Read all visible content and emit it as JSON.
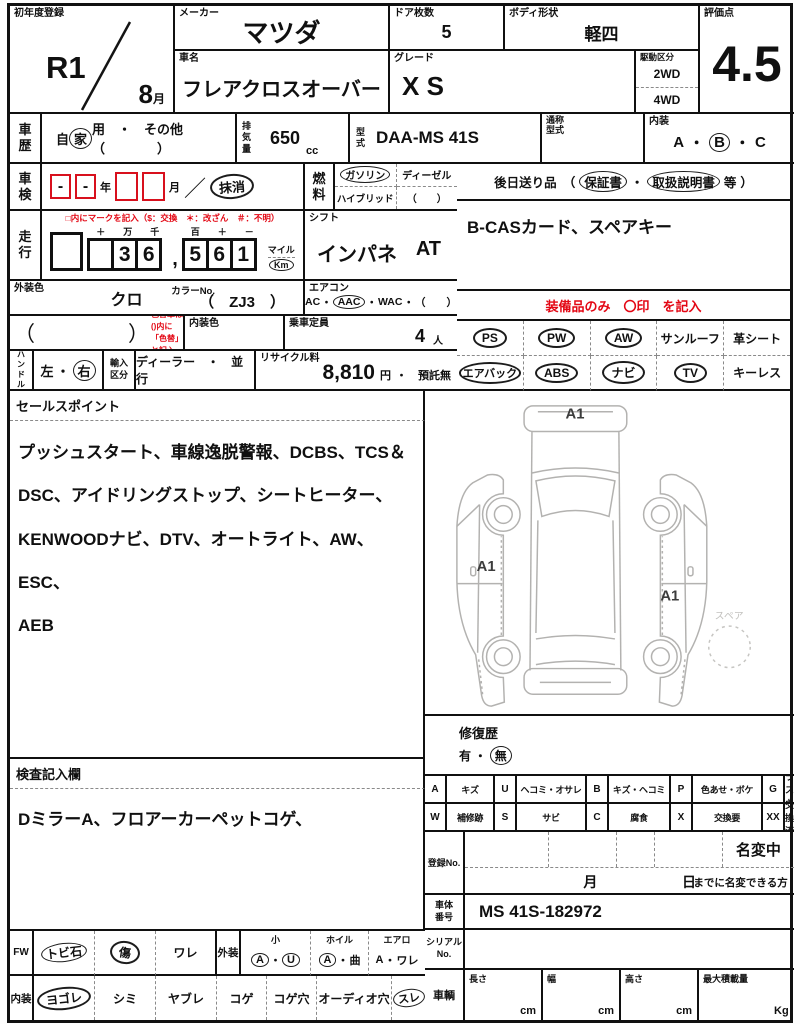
{
  "header": {
    "first_reg": {
      "label": "初年度登録",
      "year": "R1",
      "month": "8",
      "month_unit": "月"
    },
    "maker": {
      "label": "メーカー",
      "value": "マツダ"
    },
    "car_name": {
      "label": "車名",
      "value": "フレアクロスオーバー"
    },
    "doors": {
      "label": "ドア枚数",
      "value": "5"
    },
    "body_shape": {
      "label": "ボディ形状",
      "value": "軽四"
    },
    "grade": {
      "label": "グレード",
      "value": "X S"
    },
    "drive": {
      "label": "駆動区分",
      "opt1": "2WD",
      "opt2": "4WD"
    },
    "score": {
      "label": "評価点",
      "value": "4.5"
    }
  },
  "row2": {
    "history": {
      "label": "車歴",
      "pre": "自",
      "circled": "家",
      "post": "用　・　その他　（　　　　）"
    },
    "displacement": {
      "label": "排気量",
      "value": "650",
      "unit": "cc"
    },
    "model": {
      "label": "型式",
      "value": "DAA-MS 41S"
    },
    "alias": {
      "label": "通称\n型式",
      "value": ""
    },
    "interior_grade": {
      "label": "内装",
      "a": "A",
      "s1": "・",
      "b": "B",
      "s2": "・",
      "c": "C"
    }
  },
  "row3": {
    "shaken": {
      "label": "車検",
      "box1": "-",
      "box2": "-",
      "year": "年",
      "month": "月",
      "slash": "／",
      "stamp": "抹消"
    },
    "fuel": {
      "label": "燃料",
      "o1": "ガソリン",
      "o2": "ディーゼル",
      "o3": "ハイブリッド",
      "o4": "（　　）"
    },
    "send_later": {
      "pre": "後日送り品　（",
      "item1": "保証書",
      "sep": "・",
      "item2": "取扱説明書",
      "etc": "等",
      "post": "）"
    }
  },
  "row4": {
    "mileage": {
      "label": "走行",
      "note": "□内にマークを記入（$：交換　＊：改ざん　＃：不明）",
      "heads1": [
        "＋",
        "万",
        "千"
      ],
      "digits1": [
        "",
        "3",
        "6"
      ],
      "comma": ",",
      "heads2": [
        "百",
        "＋",
        "－"
      ],
      "digits2": [
        "5",
        "6",
        "1"
      ],
      "mile": "マイル",
      "km": "Km"
    },
    "shift": {
      "label": "シフト",
      "value": "インパネ",
      "trans": "AT"
    },
    "accessories": "B-CASカード、スペアキー"
  },
  "row5": {
    "ext_color": {
      "label": "外装色",
      "value": "クロ",
      "color_no_label": "カラーNo.",
      "color_no": "（　ZJ3　）"
    },
    "aircon": {
      "label": "エアコン",
      "o1": "AC",
      "s1": "・",
      "o2": "AAC",
      "s2": "・",
      "o3": "WAC",
      "s3": "・",
      "o4": "（　　）"
    },
    "equip_note": "装備品のみ　〇印　を記入"
  },
  "row6": {
    "color_change": {
      "paren": "（　　　　　）",
      "note": "色替車は()内に\n「色替」と記入"
    },
    "int_color": {
      "label": "内装色",
      "value": ""
    },
    "capacity": {
      "label": "乗車定員",
      "value": "4",
      "unit": "人"
    }
  },
  "row7": {
    "handle": {
      "label": "ハンドル",
      "left": "左",
      "sep": "・",
      "right": "右"
    },
    "import": {
      "label": "輸入\n区分",
      "value": "ディーラー　・　並行"
    },
    "recycle": {
      "label": "リサイクル料",
      "fee": "8,810",
      "yen": "円",
      "suffix": "・　預託無"
    }
  },
  "equipment": {
    "row1": [
      {
        "label": "PS",
        "circled": true
      },
      {
        "label": "PW",
        "circled": true
      },
      {
        "label": "AW",
        "circled": true
      },
      {
        "label": "サンルーフ",
        "circled": false
      },
      {
        "label": "革シート",
        "circled": false
      }
    ],
    "row2": [
      {
        "label": "エアバック",
        "circled": true
      },
      {
        "label": "ABS",
        "circled": true
      },
      {
        "label": "ナビ",
        "circled": true
      },
      {
        "label": "TV",
        "circled": true
      },
      {
        "label": "キーレス",
        "circled": false
      }
    ]
  },
  "sales_point": {
    "label": "セールスポイント",
    "text": "プッシュスタート、車線逸脱警報、DCBS、TCS＆\nDSC、アイドリングストップ、シートヒーター、\nKENWOODナビ、DTV、オートライト、AW、ESC、\nAEB"
  },
  "inspection": {
    "label": "検査記入欄",
    "text": "DミラーA、フロアーカーペットコゲ、"
  },
  "diagram": {
    "a1_top": "A1",
    "a1_left": "A1",
    "a1_right": "A1",
    "spare": "スペア"
  },
  "repair": {
    "label": "修復歴",
    "yes": "有",
    "sep": "・",
    "no": "無"
  },
  "legend": {
    "row1": [
      {
        "k": "A",
        "v": "キズ"
      },
      {
        "k": "U",
        "v": "ヘコミ・オサレ"
      },
      {
        "k": "B",
        "v": "キズ・ヘコミ"
      },
      {
        "k": "P",
        "v": "色あせ・ボケ"
      },
      {
        "k": "G",
        "v": "ガラスキズ"
      }
    ],
    "row2": [
      {
        "k": "W",
        "v": "補修跡"
      },
      {
        "k": "S",
        "v": "サビ"
      },
      {
        "k": "C",
        "v": "腐食"
      },
      {
        "k": "X",
        "v": "交換要"
      },
      {
        "k": "XX",
        "v": "交換済"
      }
    ]
  },
  "reg_no": {
    "label": "登録No.",
    "name_change": "名変中",
    "month": "月",
    "day": "日",
    "note": "までに名変できる方"
  },
  "chassis": {
    "label": "車体\n番号",
    "value": "MS 41S-182972"
  },
  "serial": {
    "label": "シリアル\nNo.",
    "value": ""
  },
  "vehicle": {
    "label": "車輌",
    "dims": [
      {
        "label": "長さ",
        "unit": "cm"
      },
      {
        "label": "幅",
        "unit": "cm"
      },
      {
        "label": "高さ",
        "unit": "cm"
      },
      {
        "label": "最大積載量",
        "unit": "Kg"
      }
    ]
  },
  "bottom_left": {
    "row1": {
      "label": "FW",
      "cells": [
        {
          "label": "トビ石",
          "circled": true
        },
        {
          "label": "傷",
          "circled": true
        },
        {
          "label": "ワレ",
          "circled": false
        }
      ],
      "ext_label": "外装",
      "sub": [
        {
          "head": "小",
          "p1": "A",
          "s": "・",
          "p2": "U"
        },
        {
          "head": "ホイル",
          "p1": "A",
          "s": "・",
          "p2": "曲"
        },
        {
          "head": "エアロ",
          "p1": "A",
          "s": "・",
          "p2": "ワレ"
        }
      ]
    },
    "row2": {
      "label": "内装",
      "cells": [
        {
          "label": "ヨゴレ",
          "circled": true
        },
        {
          "label": "シミ",
          "circled": false
        },
        {
          "label": "ヤブレ",
          "circled": false
        },
        {
          "label": "コゲ",
          "circled": false
        },
        {
          "label": "コゲ穴",
          "circled": false
        },
        {
          "label": "オーディオ穴",
          "circled": false
        },
        {
          "label": "スレ",
          "circled": true
        }
      ]
    }
  }
}
